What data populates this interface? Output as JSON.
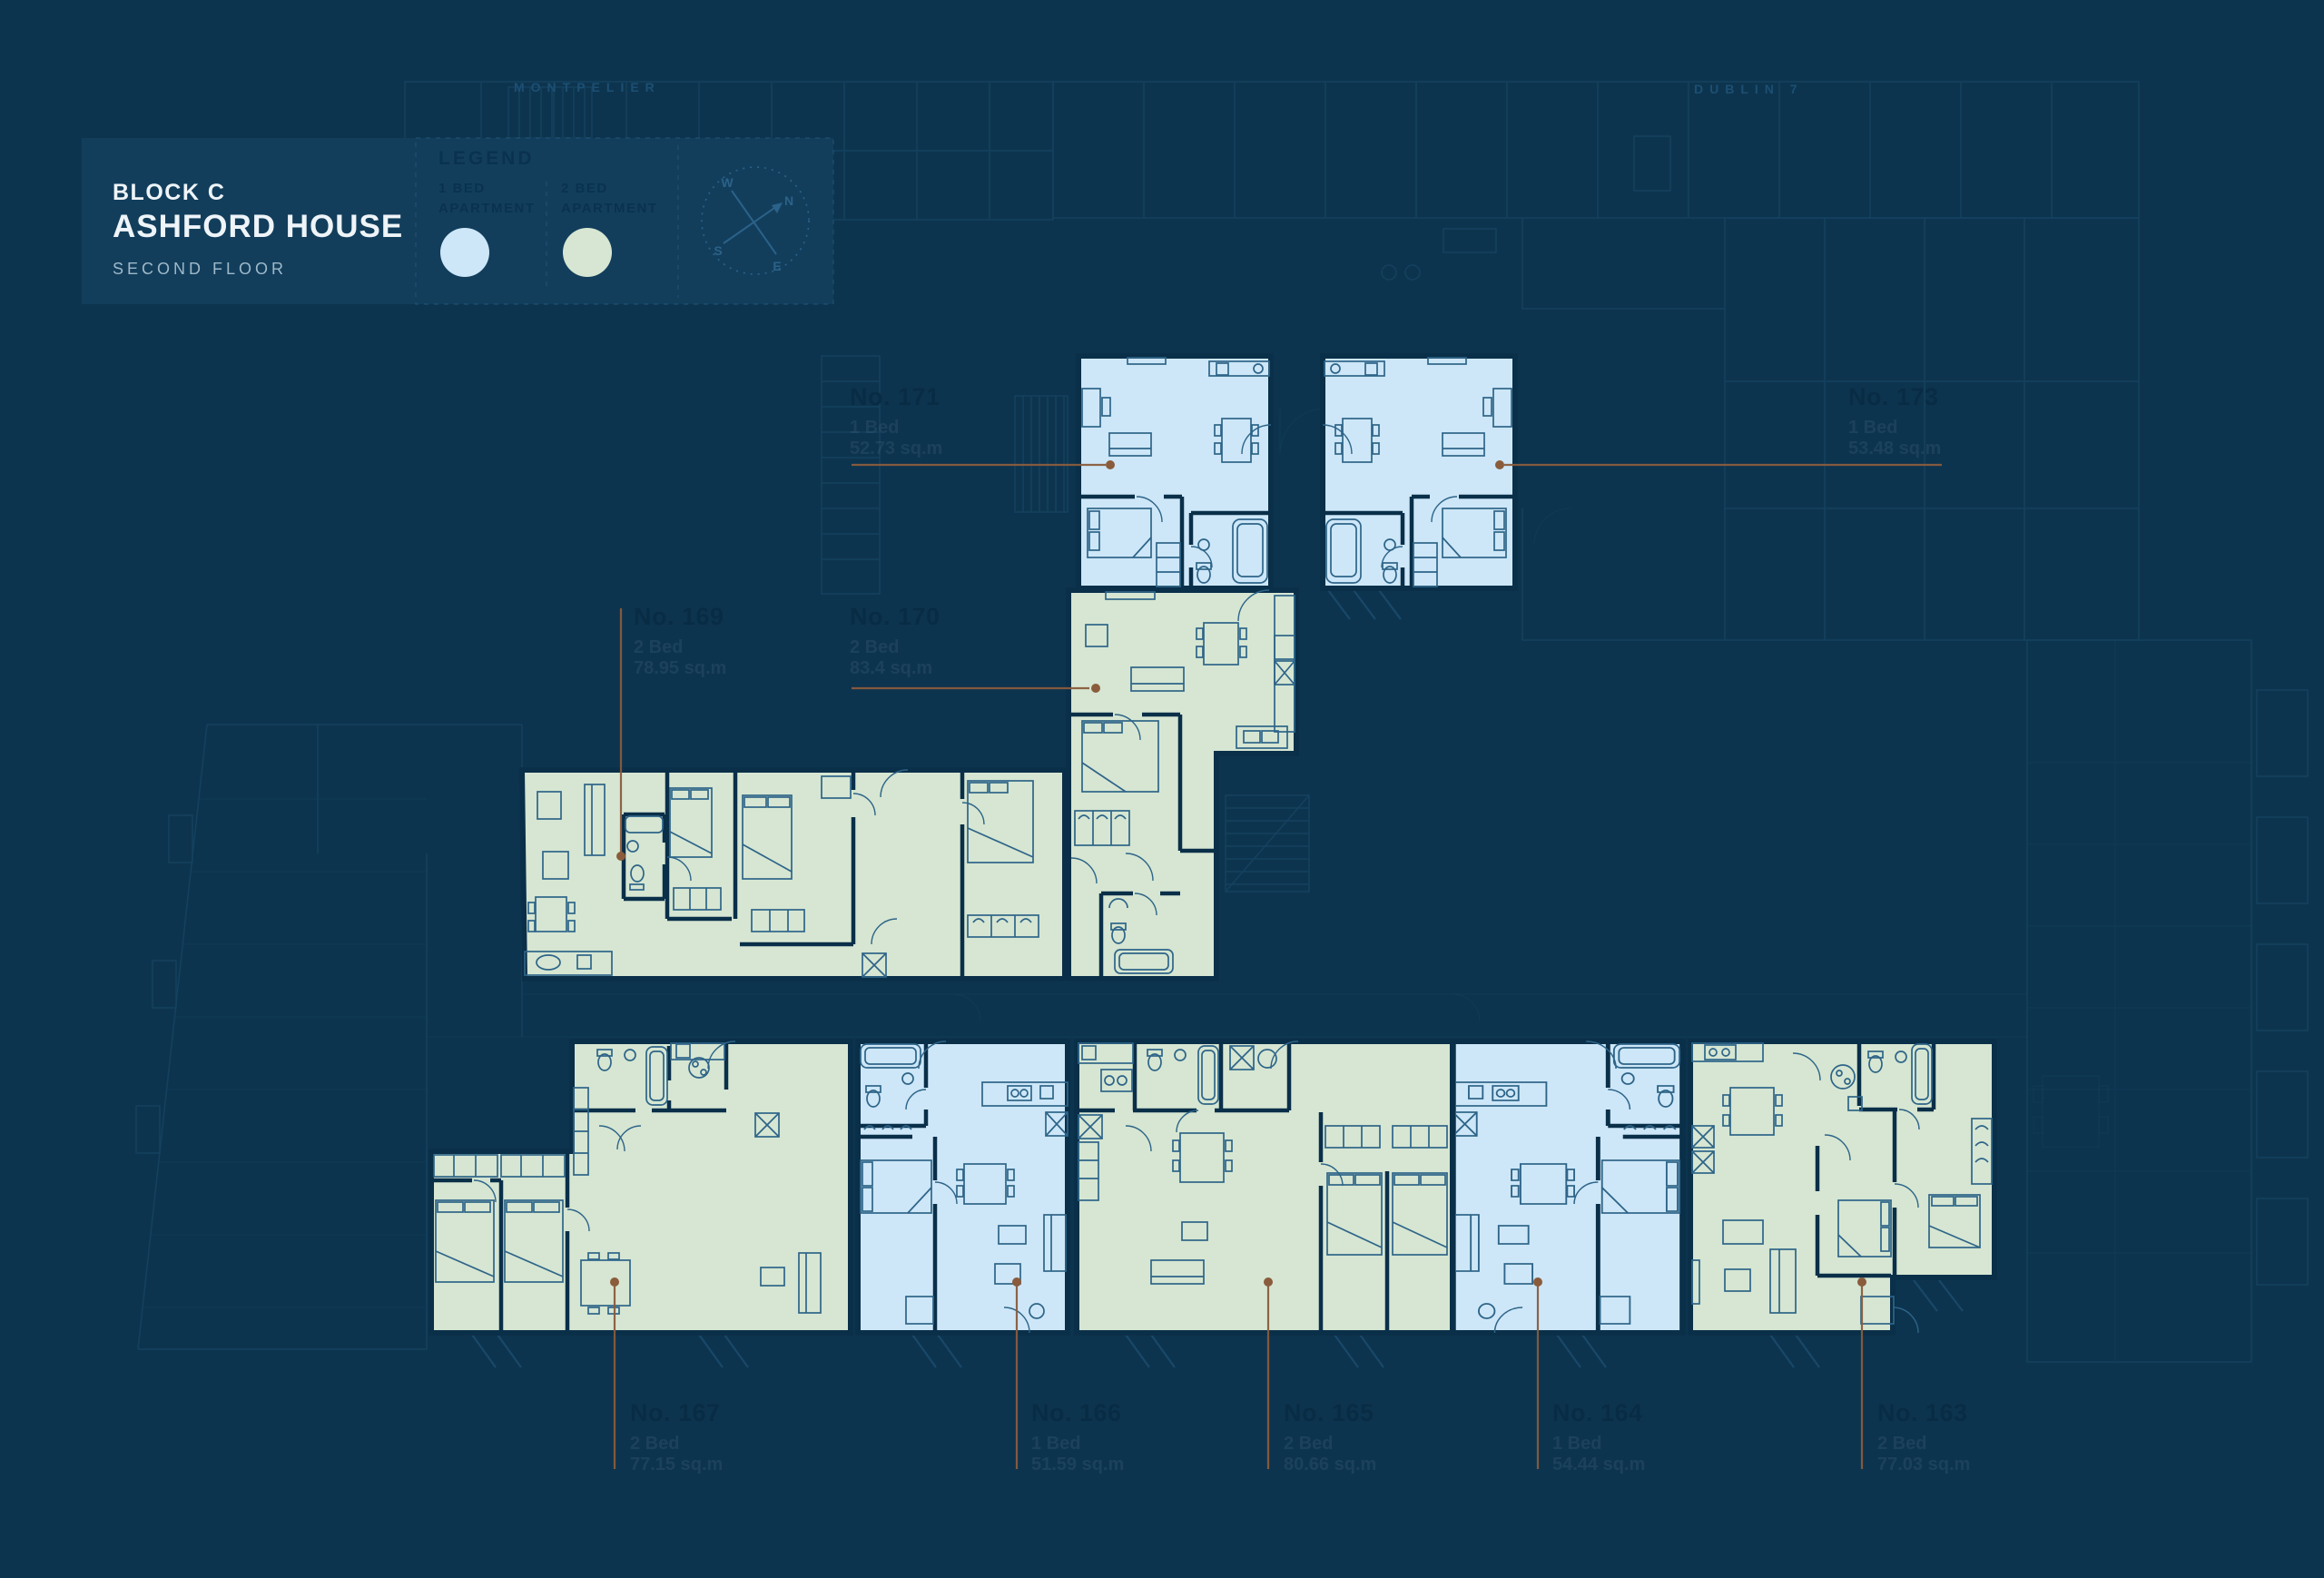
{
  "title": {
    "block": "BLOCK C",
    "name": "ASHFORD HOUSE",
    "floor": "SECOND FLOOR"
  },
  "context_labels": {
    "left": "MONTPELIER",
    "right": "DUBLIN 7"
  },
  "legend": {
    "heading": "LEGEND",
    "items": [
      {
        "line1": "1 BED",
        "line2": "APARTMENT"
      },
      {
        "line1": "2 BED",
        "line2": "APARTMENT"
      }
    ]
  },
  "compass": {
    "n": "N",
    "s": "S",
    "e": "E",
    "w": "W"
  },
  "apartments": [
    {
      "number": "No. 171",
      "beds": "1 Bed",
      "area": "52.73 sq.m",
      "type": "1-bed"
    },
    {
      "number": "No. 173",
      "beds": "1 Bed",
      "area": "53.48 sq.m",
      "type": "1-bed"
    },
    {
      "number": "No. 169",
      "beds": "2 Bed",
      "area": "78.95 sq.m",
      "type": "2-bed"
    },
    {
      "number": "No. 170",
      "beds": "2 Bed",
      "area": "83.4 sq.m",
      "type": "2-bed"
    },
    {
      "number": "No. 167",
      "beds": "2 Bed",
      "area": "77.15 sq.m",
      "type": "2-bed"
    },
    {
      "number": "No. 166",
      "beds": "1 Bed",
      "area": "51.59 sq.m",
      "type": "1-bed"
    },
    {
      "number": "No. 165",
      "beds": "2 Bed",
      "area": "80.66 sq.m",
      "type": "2-bed"
    },
    {
      "number": "No. 164",
      "beds": "1 Bed",
      "area": "54.44 sq.m",
      "type": "1-bed"
    },
    {
      "number": "No. 163",
      "beds": "2 Bed",
      "area": "77.03 sq.m",
      "type": "2-bed"
    }
  ],
  "colors": {
    "background": "#0d344e",
    "panel": "#123e5c",
    "panel_border": "#235578",
    "one_bed": "#cde7f8",
    "two_bed": "#d6e6d2",
    "wall": "#0a2f49",
    "furniture": "#2e6488",
    "faint": "#1d4e70",
    "leader": "#8a5c3c",
    "label_number": "#092c45",
    "label_sub": "#46688445",
    "title_text": "#eef4f8",
    "subtitle_text": "#9fb9c9",
    "legend_text": "#0a3150",
    "compass": "#2b6289",
    "context_text": "#1c4f73"
  }
}
